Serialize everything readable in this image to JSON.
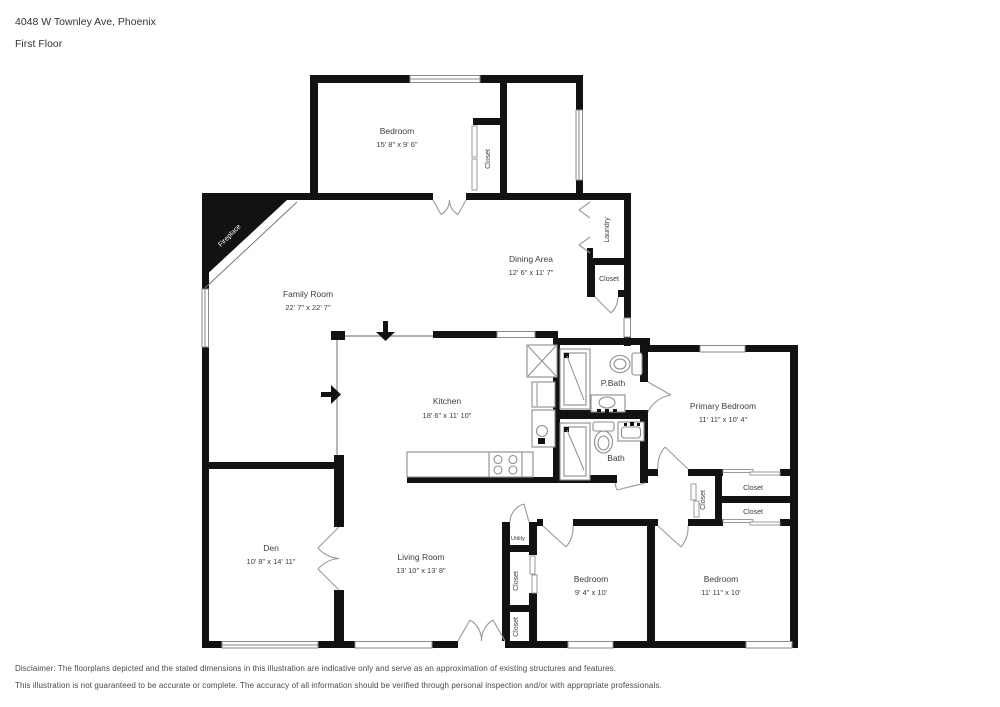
{
  "header": {
    "address": "4048 W Townley Ave, Phoenix",
    "floor": "First Floor"
  },
  "rooms": {
    "bedroom_top": {
      "name": "Bedroom",
      "dims": "15' 8\" x 9' 6\""
    },
    "dining_area": {
      "name": "Dining Area",
      "dims": "12' 6\" x 11' 7\""
    },
    "family_room": {
      "name": "Family Room",
      "dims": "22' 7\" x 22' 7\""
    },
    "kitchen": {
      "name": "Kitchen",
      "dims": "18' 6\" x 11' 10\""
    },
    "primary_bedroom": {
      "name": "Primary Bedroom",
      "dims": "11' 11\" x 10' 4\""
    },
    "pbath": {
      "name": "P.Bath"
    },
    "bath": {
      "name": "Bath"
    },
    "den": {
      "name": "Den",
      "dims": "10' 8\" x 14' 11\""
    },
    "living_room": {
      "name": "Living Room",
      "dims": "13' 10\" x 13' 8\""
    },
    "bedroom_left": {
      "name": "Bedroom",
      "dims": "9' 4\" x 10'"
    },
    "bedroom_right": {
      "name": "Bedroom",
      "dims": "11' 11\" x 10'"
    },
    "laundry": {
      "name": "Laundry"
    },
    "utility": {
      "name": "Utility"
    },
    "fireplace": {
      "name": "Fireplace"
    }
  },
  "closets": {
    "bedroom_top": "Closet",
    "laundry": "Closet",
    "hall": "Closet",
    "primary": "Closet",
    "bedroom_right": "Closet",
    "mid": "Closet",
    "bottom": "Closet"
  },
  "disclaimer": {
    "line1": "Disclaimer: The floorplans depicted and the stated dimensions in this illustration are indicative only and serve as an approximation of existing structures and features.",
    "line2": "This illustration is not guaranteed to be accurate or complete. The accuracy of all information should be verified through personal inspection and/or with appropriate professionals."
  },
  "colors": {
    "wall": "#121212",
    "label_text": "#3d3d3d",
    "disclaimer_text": "#4a4a4a"
  }
}
